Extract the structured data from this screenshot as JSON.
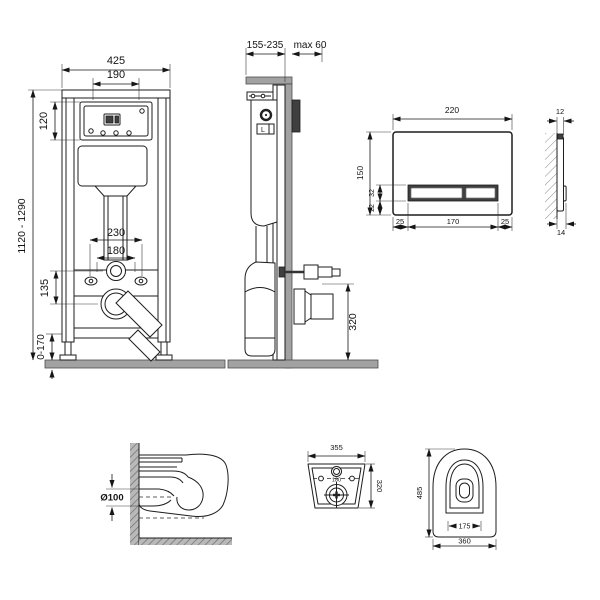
{
  "title": "wall-hung-toilet-installation-system-technical-drawing",
  "colors": {
    "line": "#1d1d1d",
    "wall_gray": "#a2a2a2",
    "block_dark": "#3f3f3f",
    "background": "#ffffff"
  },
  "views": {
    "frame_front": {
      "label": "installation-frame-front-view",
      "dims": {
        "width": "425",
        "inner_width": "190",
        "access_height": "120",
        "height_range": "1120 - 1290",
        "fixing_outer": "230",
        "fixing_inner": "180",
        "outlet_offset": "135",
        "feet_range": "0-170"
      }
    },
    "frame_side": {
      "label": "installation-frame-side-view",
      "cistern_label": "L",
      "dims": {
        "depth_range": "155-235",
        "wall_max": "max 60",
        "outlet_height": "320"
      }
    },
    "plate_front": {
      "label": "flush-plate-front-view",
      "dims": {
        "width": "220",
        "height": "150",
        "button_height": "32",
        "button_offset": "22",
        "left_margin": "25",
        "button_width": "170",
        "right_margin": "25"
      }
    },
    "plate_side": {
      "label": "flush-plate-side-view",
      "dims": {
        "top_thickness": "12",
        "bottom_thickness": "14"
      }
    },
    "bowl_section": {
      "label": "bowl-section-view",
      "dims": {
        "drain_diameter": "Ø100"
      }
    },
    "bowl_rear": {
      "label": "bowl-rear-view",
      "dims": {
        "width": "355",
        "height": "320",
        "hole_spacing": "180"
      }
    },
    "bowl_top": {
      "label": "bowl-top-view",
      "dims": {
        "depth": "485",
        "inner_width": "175",
        "width": "360"
      }
    }
  }
}
